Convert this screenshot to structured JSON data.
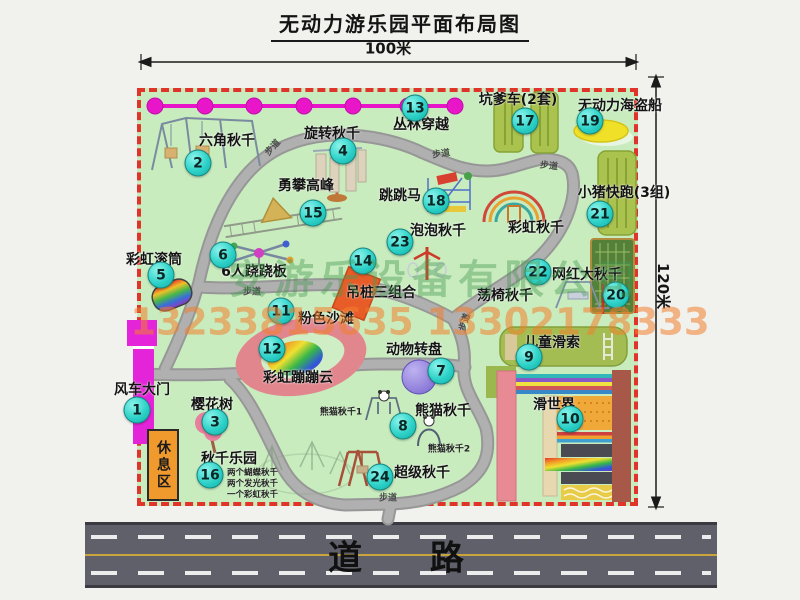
{
  "title": "无动力游乐园平面布局图",
  "dimensions": {
    "width_label": "100米",
    "height_label": "120米"
  },
  "map": {
    "attractions": [
      {
        "num": "1",
        "name": "风车大门"
      },
      {
        "num": "2",
        "name": "六角秋千"
      },
      {
        "num": "3",
        "name": "樱花树"
      },
      {
        "num": "4",
        "name": "旋转秋千"
      },
      {
        "num": "5",
        "name": "彩虹滚筒"
      },
      {
        "num": "6",
        "name": "6人跷跷板"
      },
      {
        "num": "7",
        "name": "动物转盘"
      },
      {
        "num": "8",
        "name": "熊猫秋千"
      },
      {
        "num": "9",
        "name": "儿童滑索"
      },
      {
        "num": "10",
        "name": "滑世界"
      },
      {
        "num": "11",
        "name": "粉色沙滩"
      },
      {
        "num": "12",
        "name": "彩虹蹦蹦云"
      },
      {
        "num": "13",
        "name": "丛林穿越"
      },
      {
        "num": "14",
        "name": "吊桩三组合"
      },
      {
        "num": "15",
        "name": "勇攀高峰"
      },
      {
        "num": "16",
        "name": "秋千乐园"
      },
      {
        "num": "17",
        "name": "坑爹车(2套)"
      },
      {
        "num": "18",
        "name": "跳跳马"
      },
      {
        "num": "19",
        "name": "无动力海盗船"
      },
      {
        "num": "20",
        "name": "网红大秋千"
      },
      {
        "num": "21",
        "name": "小猪快跑(3组)"
      },
      {
        "num": "22",
        "name": "荡椅秋千"
      },
      {
        "num": "23",
        "name": "泡泡秋千"
      },
      {
        "num": "24",
        "name": "超级秋千"
      }
    ],
    "unnumbered": {
      "rainbow_swing": "彩虹秋千",
      "rest_area": "休息区",
      "path_label": "步道"
    },
    "notes": {
      "panda1": "熊猫秋千1",
      "panda2": "熊猫秋千2",
      "swing1": "两个蝴蝶秋千",
      "swing2": "两个发光秋千",
      "swing3": "一个彩虹秋千"
    }
  },
  "watermark": {
    "company": "安游乐设备有限公司",
    "phone": "13233815635 13302178333"
  },
  "street": {
    "label": "道 路"
  },
  "colors": {
    "map_green": "#c9ecbf",
    "border_red": "#e0342a",
    "bubble_teal": "#2ed2c8",
    "gate_magenta": "#e424d8",
    "chain_magenta": "#e816c8",
    "road_gray": "#a8a8a8",
    "street_dark": "#60606a",
    "rest_area_orange": "#f09a2e",
    "pirate_ship_yellow": "#f0e028",
    "beach_pink": "#e2868e"
  }
}
